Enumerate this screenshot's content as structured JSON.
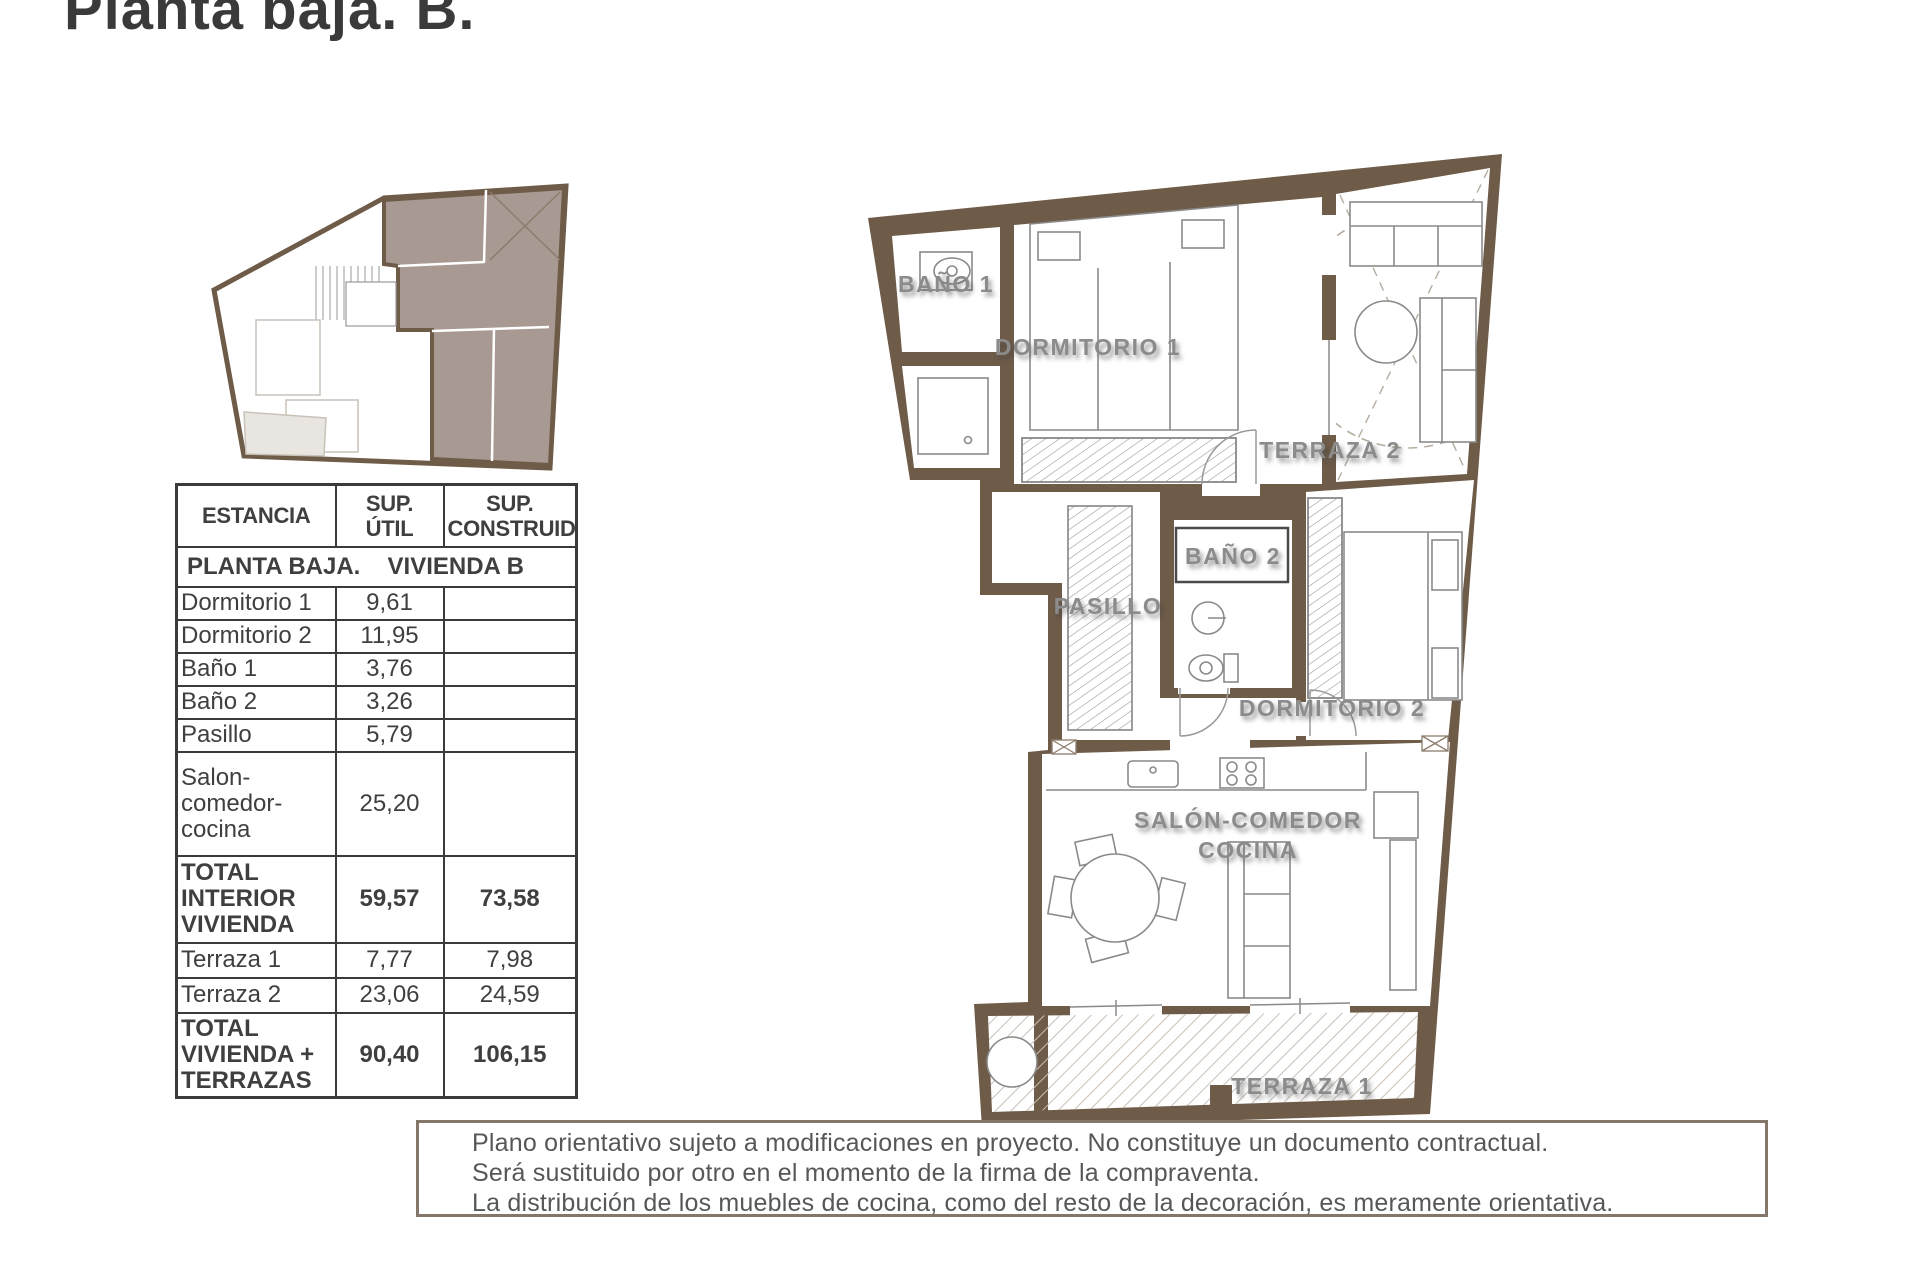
{
  "title": "Planta baja. B.",
  "table": {
    "headers": [
      "ESTANCIA",
      "SUP. ÚTIL",
      "SUP. CONSTRUIDA"
    ],
    "section": {
      "left": "PLANTA BAJA.",
      "right": "VIVIENDA B"
    },
    "rows": [
      {
        "name": "Dormitorio 1",
        "util": "9,61",
        "built": ""
      },
      {
        "name": "Dormitorio 2",
        "util": "11,95",
        "built": ""
      },
      {
        "name": "Baño 1",
        "util": "3,76",
        "built": ""
      },
      {
        "name": "Baño 2",
        "util": "3,26",
        "built": ""
      },
      {
        "name": "Pasillo",
        "util": "5,79",
        "built": ""
      },
      {
        "name": "Salon-comedor-cocina",
        "util": "25,20",
        "built": ""
      },
      {
        "name": "TOTAL INTERIOR VIVIENDA",
        "util": "59,57",
        "built": "73,58"
      },
      {
        "name": "Terraza 1",
        "util": "7,77",
        "built": "7,98"
      },
      {
        "name": "Terraza 2",
        "util": "23,06",
        "built": "24,59"
      },
      {
        "name": "TOTAL VIVIENDA + TERRAZAS",
        "util": "90,40",
        "built": "106,15"
      }
    ]
  },
  "plan": {
    "labels": {
      "bano1": "BAÑO 1",
      "dormitorio1": "DORMITORIO 1",
      "terraza2": "TERRAZA 2",
      "bano2": "BAÑO 2",
      "pasillo": "PASILLO",
      "dormitorio2": "DORMITORIO 2",
      "salon_line1": "SALÓN-COMEDOR",
      "salon_line2": "COCINA",
      "terraza1": "TERRAZA 1"
    }
  },
  "disclaimer": {
    "lines": [
      "Plano orientativo sujeto a modificaciones en proyecto. No constituye un documento contractual.",
      "Será sustituido por otro en el momento de la firma de la compraventa.",
      "La distribución de los muebles de cocina, como del resto de la decoración, es meramente orientativa."
    ]
  },
  "colors": {
    "wall_brown": "#6e5b48",
    "unit_highlight": "#a89a92",
    "label_gray": "#8b8b8b",
    "table_border": "#3a3a3a",
    "disclaimer_border": "#85766a",
    "hatch": "#c8c0b4"
  }
}
